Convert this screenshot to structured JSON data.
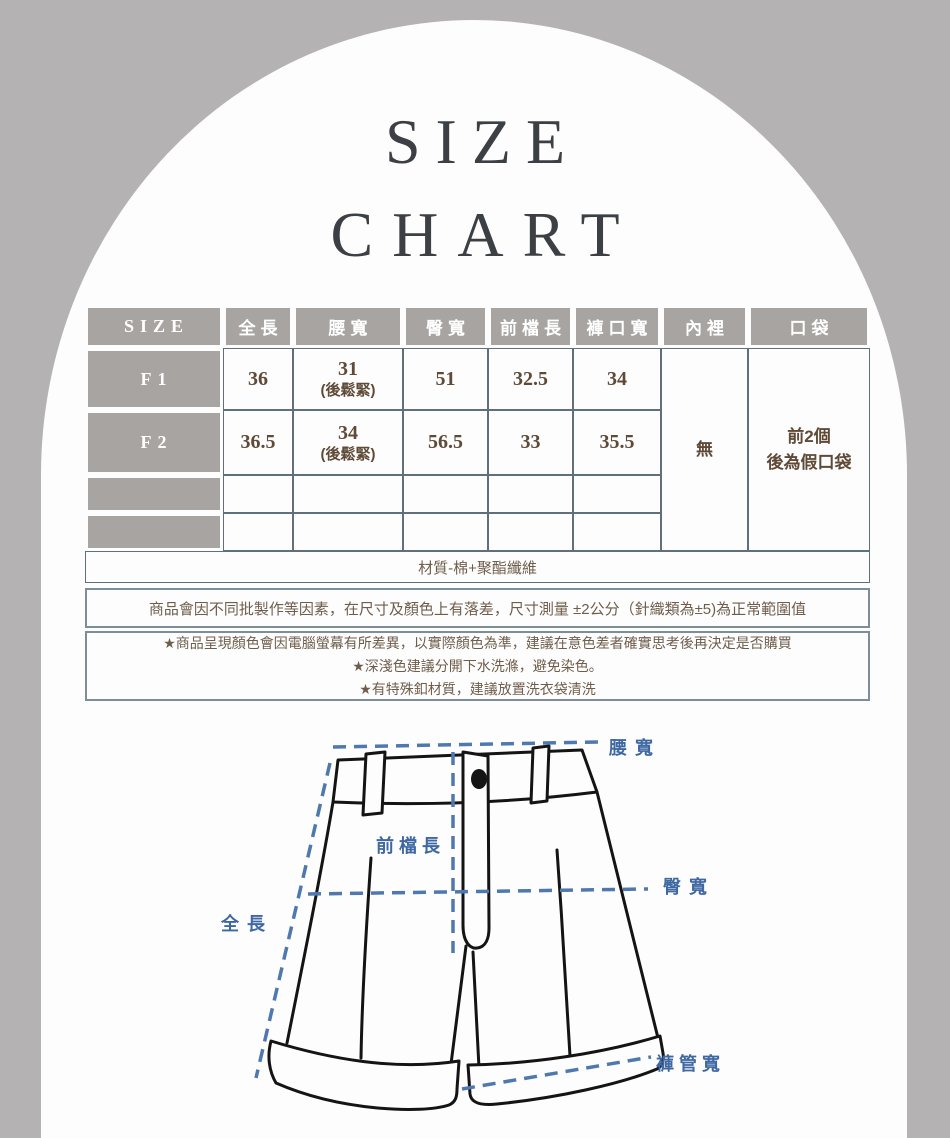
{
  "title": {
    "line1": "SIZE",
    "line2": "CHART"
  },
  "table": {
    "headers": [
      "SIZE",
      "全長",
      "腰寬",
      "臀寬",
      "前檔長",
      "褲口寬",
      "內裡",
      "口袋"
    ],
    "rows": [
      {
        "size": "F1",
        "full_length": "36",
        "waist": "31",
        "waist_note": "(後鬆緊)",
        "hip": "51",
        "front_rise": "32.5",
        "leg_opening": "34"
      },
      {
        "size": "F2",
        "full_length": "36.5",
        "waist": "34",
        "waist_note": "(後鬆緊)",
        "hip": "56.5",
        "front_rise": "33",
        "leg_opening": "35.5"
      }
    ],
    "lining": "無",
    "pocket_line1": "前2個",
    "pocket_line2": "後為假口袋",
    "material": "材質-棉+聚酯纖維"
  },
  "notes": {
    "tolerance": "商品會因不同批製作等因素，在尺寸及顏色上有落差，尺寸測量 ±2公分（針織類為±5)為正常範圍值",
    "items": [
      "★商品呈現顏色會因電腦螢幕有所差異，以實際顏色為準，建議在意色差者確實思考後再決定是否購買",
      "★深淺色建議分開下水洗滌，避免染色。",
      "★有特殊釦材質，建議放置洗衣袋清洗"
    ]
  },
  "diagram": {
    "labels": {
      "waist": "腰寬",
      "front_rise": "前檔長",
      "hip": "臀寬",
      "full_length": "全長",
      "leg_opening": "褲管寬"
    }
  },
  "colors": {
    "background": "#b4b2b2",
    "arch": "#fdfdfd",
    "header_gray": "#a8a4a1",
    "table_line": "#5f707c",
    "value_brown": "#5e4a36",
    "note_brown": "#6f5d4b",
    "title_charcoal": "#3c4045",
    "measure_blue": "#4f79ae"
  }
}
